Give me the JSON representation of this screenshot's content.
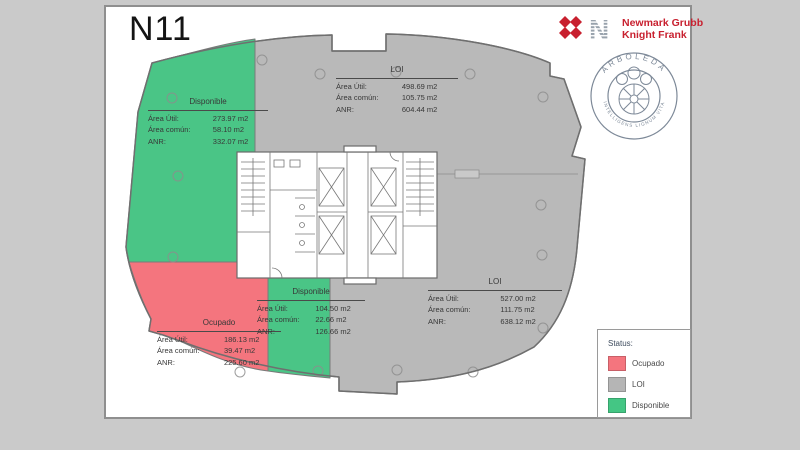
{
  "page": {
    "title": "N11"
  },
  "logo": {
    "line1": "Newmark Grubb",
    "line2": "Knight Frank"
  },
  "seal": {
    "top_text": "ARBOLEDA",
    "bottom_text": "INTELLIGENS LIGNUM VITA"
  },
  "labels": {
    "area_util": "Área Útil:",
    "area_comun": "Área común:",
    "anr": "ANR:"
  },
  "zones": [
    {
      "id": "disponible-top-left",
      "status": "Disponible",
      "area_util": "273.97 m2",
      "area_comun": "58.10 m2",
      "anr": "332.07 m2"
    },
    {
      "id": "loi-top",
      "status": "LOI",
      "area_util": "498.69 m2",
      "area_comun": "105.75 m2",
      "anr": "604.44 m2"
    },
    {
      "id": "ocupado",
      "status": "Ocupado",
      "area_util": "186.13 m2",
      "area_comun": "39.47 m2",
      "anr": "225.60 m2"
    },
    {
      "id": "disponible-bottom",
      "status": "Disponible",
      "area_util": "104.50 m2",
      "area_comun": "22.66 m2",
      "anr": "126.66 m2"
    },
    {
      "id": "loi-right",
      "status": "LOI",
      "area_util": "527.00 m2",
      "area_comun": "111.75 m2",
      "anr": "638.12 m2"
    }
  ],
  "legend": {
    "title": "Status:",
    "items": [
      {
        "label": "Ocupado",
        "color": "#f4757e"
      },
      {
        "label": "LOI",
        "color": "#b5b5b5"
      },
      {
        "label": "Disponible",
        "color": "#44c684"
      }
    ]
  },
  "colors": {
    "ocupado": "#f4757e",
    "loi": "#b9b9b9",
    "disponible": "#4ac586",
    "logo_red": "#c8202f",
    "seal": "#7d8998"
  }
}
